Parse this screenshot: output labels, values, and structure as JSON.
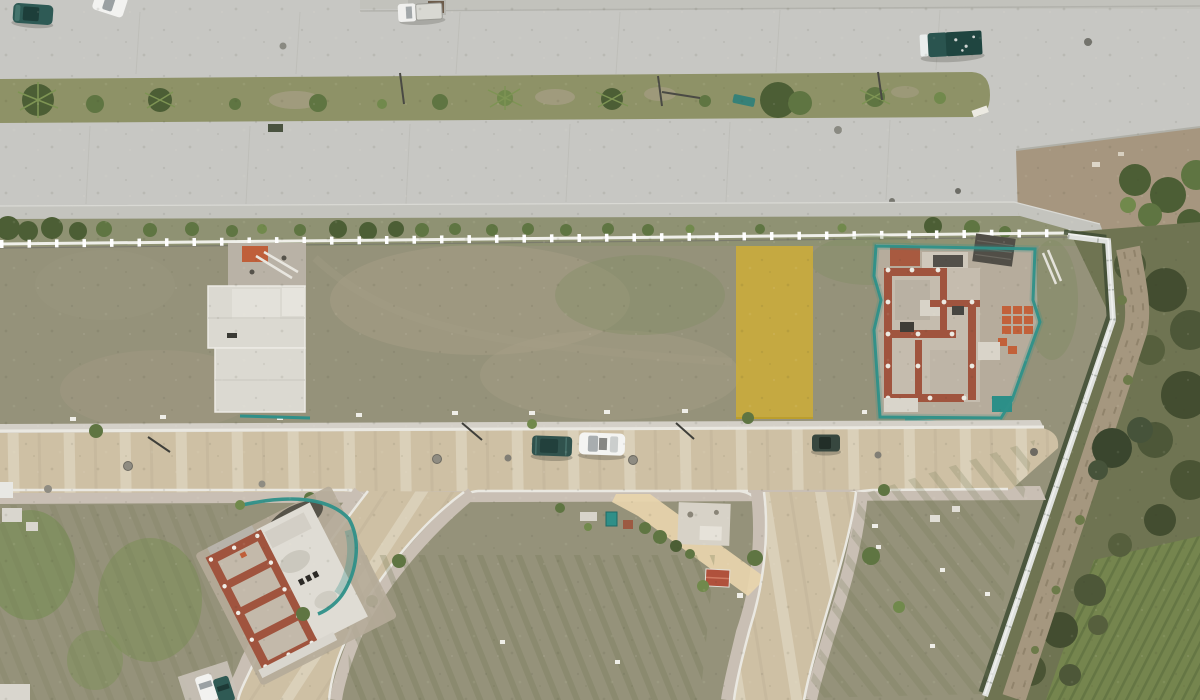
{
  "image": {
    "kind": "aerial-drone-photograph",
    "subject": "residential development under construction seen from above; a vacant lot is highlighted with a yellow overlay between a landscaped avenue and a paver street",
    "width_px": 1200,
    "height_px": 700
  },
  "highlighted_lot": {
    "marker": "semi-transparent yellow rectangle overlay on a grass lot",
    "color": "#d0ae35",
    "opacity": 0.82
  },
  "palette": {
    "concrete": "#c7c7c3",
    "concrete_joint": "#b7b7b1",
    "median_grass": "#8e9267",
    "verge_grass": "#8f9273",
    "lots_grass": "#95927a",
    "bottom_grass": "#8d9270",
    "dry_patch": "#a89f87",
    "green_patch": "#7c8a5c",
    "pavers": "#cec0a4",
    "paver_band": "#ded5c0",
    "curb": "#eae8e1",
    "sidewalk": "#c9bfb4",
    "fence_white": "#efefe9",
    "wall_white": "#dfe1de",
    "highlight_yellow": "#d0ae35",
    "mesh_teal": "#2f9089",
    "brick": "#a0543e",
    "pallet_orange": "#c2613a",
    "roof_dark": "#514e47",
    "dirt": "#b5ab99",
    "dirt_track": "#a5977f",
    "scrub": "#5a6340",
    "field": "#75854e",
    "field_row": "#5d7040",
    "tree_dark": "#4c5e35",
    "tree_mid": "#5f7542",
    "tree_light": "#71894c",
    "path_sand": "#e8d5ac",
    "car_teal": "#2f5751",
    "car_white": "#f3f3f1",
    "car_dark_green": "#36463e"
  },
  "vehicles": [
    {
      "name": "teal-sedan-avenue-top-left",
      "color": "#2e5a55"
    },
    {
      "name": "white-suv-avenue-top-left",
      "color": "#f2f2f0"
    },
    {
      "name": "white-pickup-avenue-top",
      "color": "#f0f0ee"
    },
    {
      "name": "teal-pickup-avenue-right",
      "color": "#2a544f"
    },
    {
      "name": "teal-wagon-paver-street",
      "color": "#30524d"
    },
    {
      "name": "white-sedan-paver-street",
      "color": "#f4f4f2"
    },
    {
      "name": "dark-green-car-paver-street",
      "color": "#37473f"
    },
    {
      "name": "white-car-branch-street-corner",
      "color": "#f2f2f0"
    },
    {
      "name": "teal-car-branch-street-corner",
      "color": "#2f5a54"
    }
  ],
  "landmarks": [
    "divided-avenue-with-landscaped-median",
    "white-boundary-fence-with-posts",
    "vacant-grass-lots",
    "highlighted-yellow-lot",
    "concrete-foundation-slab-west",
    "house-under-construction-east",
    "house-under-construction-south",
    "paver-street",
    "branch-street-southwest",
    "branch-street-south",
    "white-perimeter-wall",
    "dirt-track-outside-wall",
    "scrub-vegetation-strip",
    "crop-field-southeast",
    "sand-path",
    "red-roof-shed"
  ]
}
